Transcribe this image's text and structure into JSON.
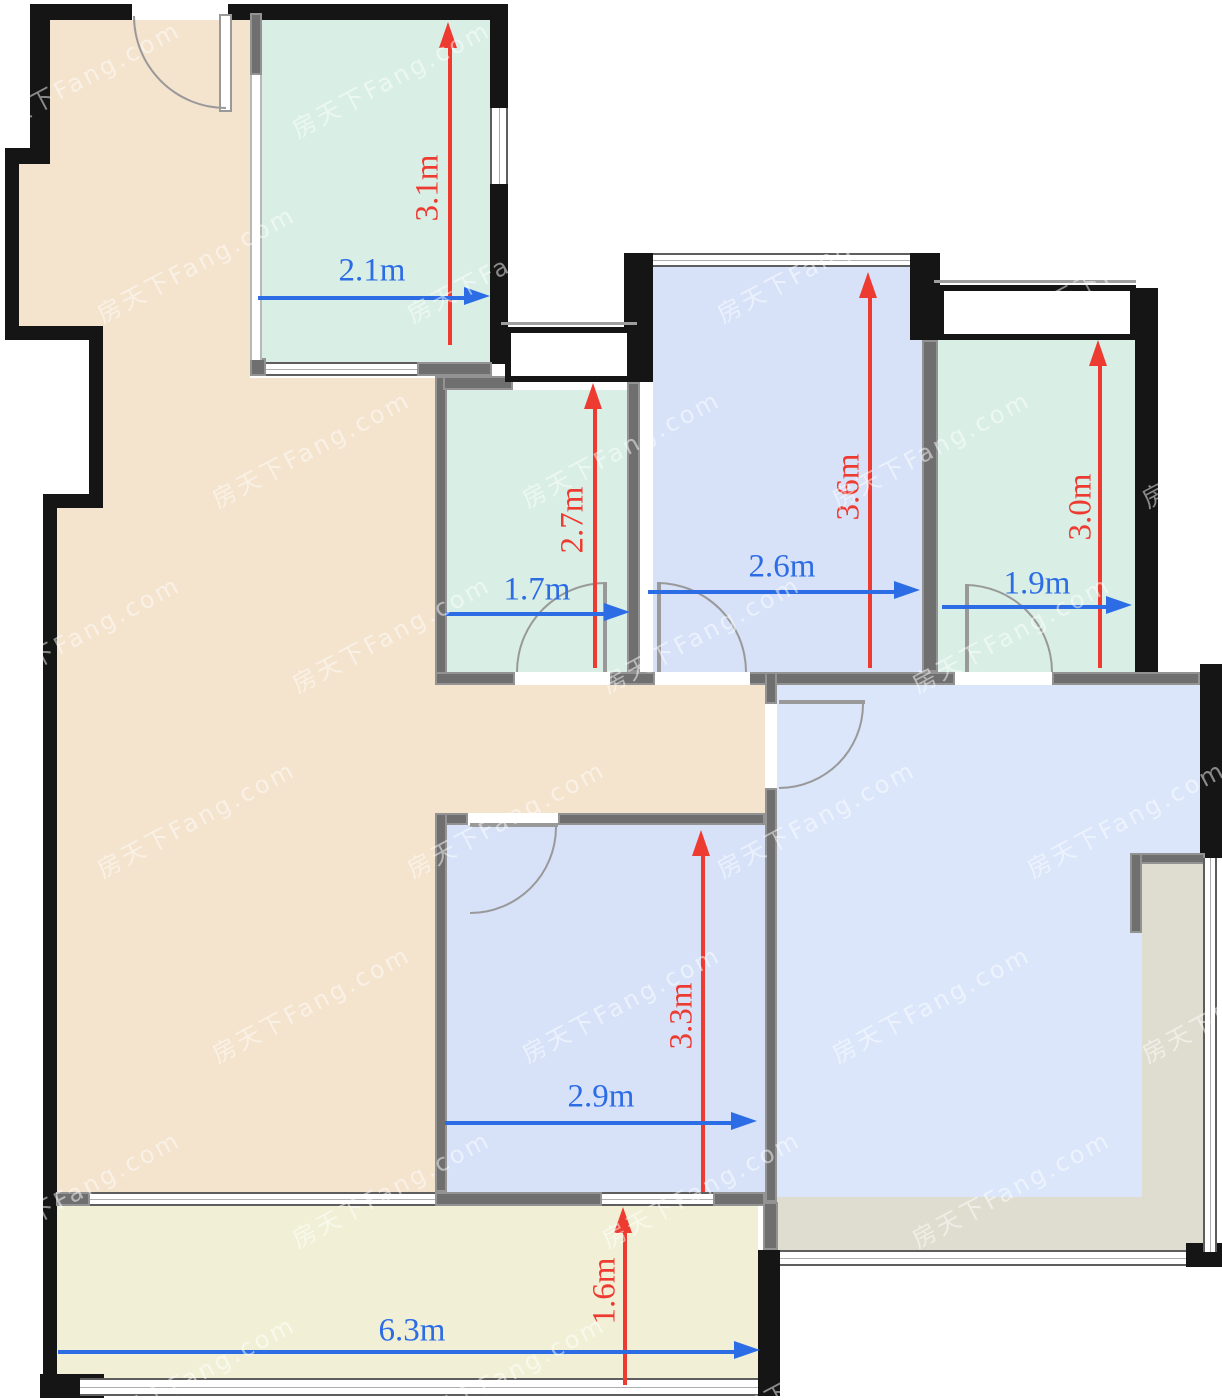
{
  "watermark": {
    "text": "房天下Fang.com"
  },
  "colors": {
    "wall": "#151515",
    "partition": "#6f6f6f",
    "peach": "#f4e3cd",
    "mint": "#d9efe6",
    "blue_room": "#d7e2f8",
    "blue_living": "#dbe6fa",
    "balcony_yellow": "#f1f0d6",
    "terrace_gray": "#dfddcf",
    "dim_red": "#ee3b31",
    "dim_blue": "#2c6ce5",
    "watermark": "rgba(255,255,255,0.5)"
  },
  "floorplan": {
    "unit": "m",
    "dimensions": [
      {
        "id": "top-mint-room-height",
        "label": "3.1m",
        "value": 3.1,
        "color": "red",
        "dir": "v",
        "x": 450,
        "y1": 22,
        "y2": 345,
        "lx": 428,
        "ly": 188
      },
      {
        "id": "top-mint-room-width",
        "label": "2.1m",
        "value": 2.1,
        "color": "blue",
        "dir": "h",
        "y": 298,
        "x1": 258,
        "x2": 490,
        "lx": 372,
        "ly": 271
      },
      {
        "id": "mid-mint-room-height",
        "label": "2.7m",
        "value": 2.7,
        "color": "red",
        "dir": "v",
        "x": 595,
        "y1": 383,
        "y2": 668,
        "lx": 573,
        "ly": 520
      },
      {
        "id": "mid-mint-room-width",
        "label": "1.7m",
        "value": 1.7,
        "color": "blue",
        "dir": "h",
        "y": 614,
        "x1": 446,
        "x2": 630,
        "lx": 537,
        "ly": 590
      },
      {
        "id": "top-blue-room-height",
        "label": "3.6m",
        "value": 3.6,
        "color": "red",
        "dir": "v",
        "x": 870,
        "y1": 272,
        "y2": 668,
        "lx": 849,
        "ly": 487
      },
      {
        "id": "top-blue-room-width",
        "label": "2.6m",
        "value": 2.6,
        "color": "blue",
        "dir": "h",
        "y": 592,
        "x1": 648,
        "x2": 920,
        "lx": 782,
        "ly": 567
      },
      {
        "id": "right-mint-room-height",
        "label": "3.0m",
        "value": 3.0,
        "color": "red",
        "dir": "v",
        "x": 1100,
        "y1": 340,
        "y2": 668,
        "lx": 1081,
        "ly": 507
      },
      {
        "id": "right-mint-room-width",
        "label": "1.9m",
        "value": 1.9,
        "color": "blue",
        "dir": "h",
        "y": 607,
        "x1": 942,
        "x2": 1132,
        "lx": 1037,
        "ly": 584
      },
      {
        "id": "bottom-blue-room-height",
        "label": "3.3m",
        "value": 3.3,
        "color": "red",
        "dir": "v",
        "x": 703,
        "y1": 830,
        "y2": 1192,
        "lx": 682,
        "ly": 1016
      },
      {
        "id": "bottom-blue-room-width",
        "label": "2.9m",
        "value": 2.9,
        "color": "blue",
        "dir": "h",
        "y": 1123,
        "x1": 445,
        "x2": 757,
        "lx": 601,
        "ly": 1097
      },
      {
        "id": "balcony-depth",
        "label": "1.6m",
        "value": 1.6,
        "color": "red",
        "dir": "v",
        "x": 625,
        "y1": 1207,
        "y2": 1385,
        "lx": 605,
        "ly": 1291
      },
      {
        "id": "balcony-width",
        "label": "6.3m",
        "value": 6.3,
        "color": "blue",
        "dir": "h",
        "y": 1352,
        "x1": 58,
        "x2": 760,
        "lx": 412,
        "ly": 1331
      }
    ]
  }
}
